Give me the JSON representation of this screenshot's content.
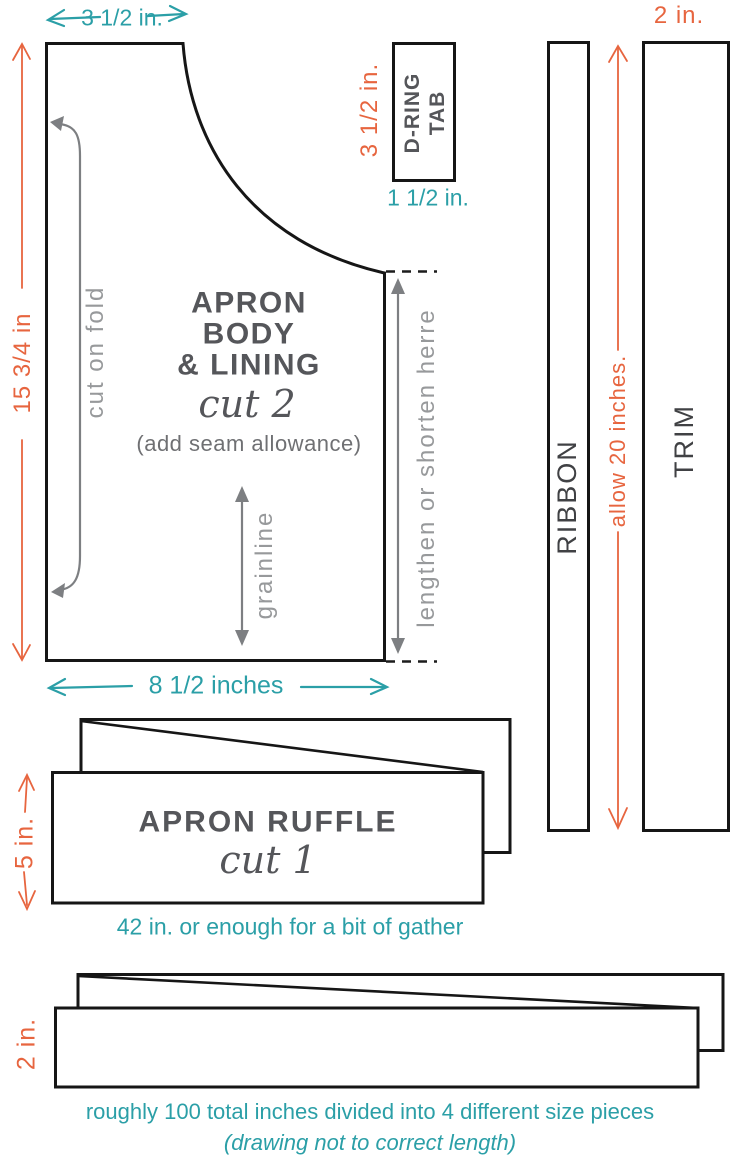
{
  "colors": {
    "teal": "#2b9fa7",
    "orange": "#e7653f",
    "outline": "#161616",
    "dark_text": "#55565a",
    "gray_text": "#97999b",
    "gray_arrow": "#7d7f82"
  },
  "apron_body": {
    "top_width": "3 1/2 in.",
    "side_height": "15 3/4 in",
    "fold": "cut on fold",
    "title1": "APRON",
    "title2": "BODY",
    "title3": "& LINING",
    "cut": "cut 2",
    "seam": "(add seam allowance)",
    "grainline": "grainline",
    "lengthen": "lengthen or shorten herre",
    "bottom_width": "8 1/2 inches"
  },
  "dring_tab": {
    "line1": "D-RING",
    "line2": "TAB",
    "height": "3 1/2 in.",
    "width": "1 1/2 in."
  },
  "ribbon": {
    "label": "RIBBON",
    "allow": "allow 20 inches."
  },
  "trim": {
    "label": "TRIM",
    "width": "2 in."
  },
  "ruffle": {
    "title": "APRON RUFFLE",
    "cut": "cut 1",
    "height": "5 in.",
    "note": "42 in. or enough for a bit of gather"
  },
  "ties": {
    "height": "2 in.",
    "note1": "roughly 100 total inches divided into 4 different size pieces",
    "note2": "(drawing not to correct length)"
  }
}
